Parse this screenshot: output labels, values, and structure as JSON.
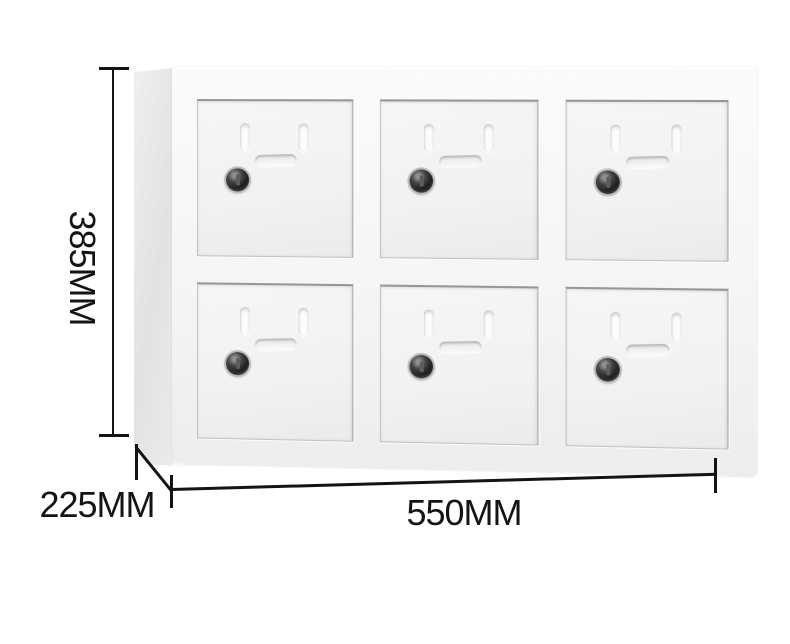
{
  "figure": {
    "type": "product-dimension-diagram",
    "subject": "White 6-door metal storage locker cabinet shown in three-quarter view on white background",
    "background_color": "#ffffff"
  },
  "cabinet": {
    "rows": 2,
    "columns": 3,
    "door_count": 6,
    "door_features": [
      "vent-slot",
      "vent-slot",
      "recessed-handle",
      "keyhole-lock"
    ],
    "colors": {
      "frame": "#f5f5f3",
      "door_face": "#f1f1ef",
      "side_panel_light": "#efefee",
      "side_panel_dark": "#e2e2e0",
      "lock_body": "#1b1b1b",
      "lock_ring": "#bcbcba"
    }
  },
  "dimensions": {
    "annotation_color": "#141414",
    "height": {
      "label": "385MM",
      "orientation": "vertical",
      "position": "left-side"
    },
    "depth": {
      "label": "225MM",
      "orientation": "diagonal",
      "position": "bottom-left"
    },
    "width": {
      "label": "550MM",
      "orientation": "horizontal",
      "position": "bottom"
    }
  }
}
